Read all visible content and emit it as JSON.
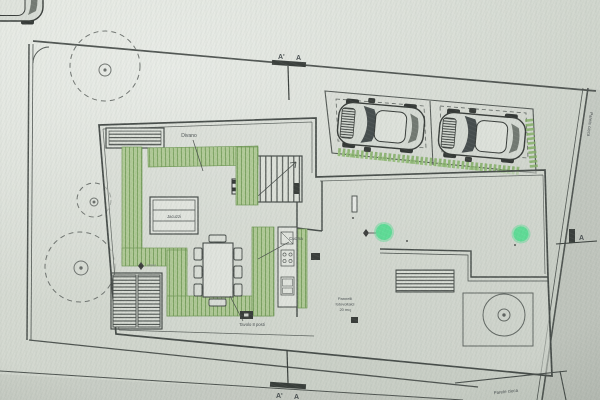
{
  "photo": {
    "subject": "Architectural ground-floor site plan (photograph of drawing)",
    "palette": {
      "paper": "#d8dcd4",
      "ink": "#3f4441",
      "plan_green_fill": "#b4d095",
      "plan_green_hatch": "#79a65a",
      "hedge_green": "#7fb25d",
      "marker_green": "#53e795",
      "car_dark": "#2c302e"
    },
    "features": {
      "trees": 4,
      "parking_spaces": 2,
      "cars": 2,
      "green_point_markers": 2
    }
  },
  "annotations": {
    "divano": "Divano",
    "jacuzzi": "Jacuzzi",
    "cucina": "Cucina",
    "tavolo": "Tavolo 8 posti",
    "note": {
      "line1": "Pannelli",
      "line2": "fotovoltaici",
      "line3": "20 mq"
    },
    "parete_cieca_right": "Parete cieca",
    "parete_cieca_bottom": "Parete cieca"
  },
  "section_markers": {
    "top": {
      "left": "A'",
      "right": "A"
    },
    "bottom": {
      "left": "A'",
      "right": "A"
    },
    "side": {
      "label": "A"
    }
  },
  "green_markers": [
    {
      "id": "marker-1",
      "x": 384,
      "y": 232
    },
    {
      "id": "marker-2",
      "x": 521,
      "y": 234
    }
  ]
}
